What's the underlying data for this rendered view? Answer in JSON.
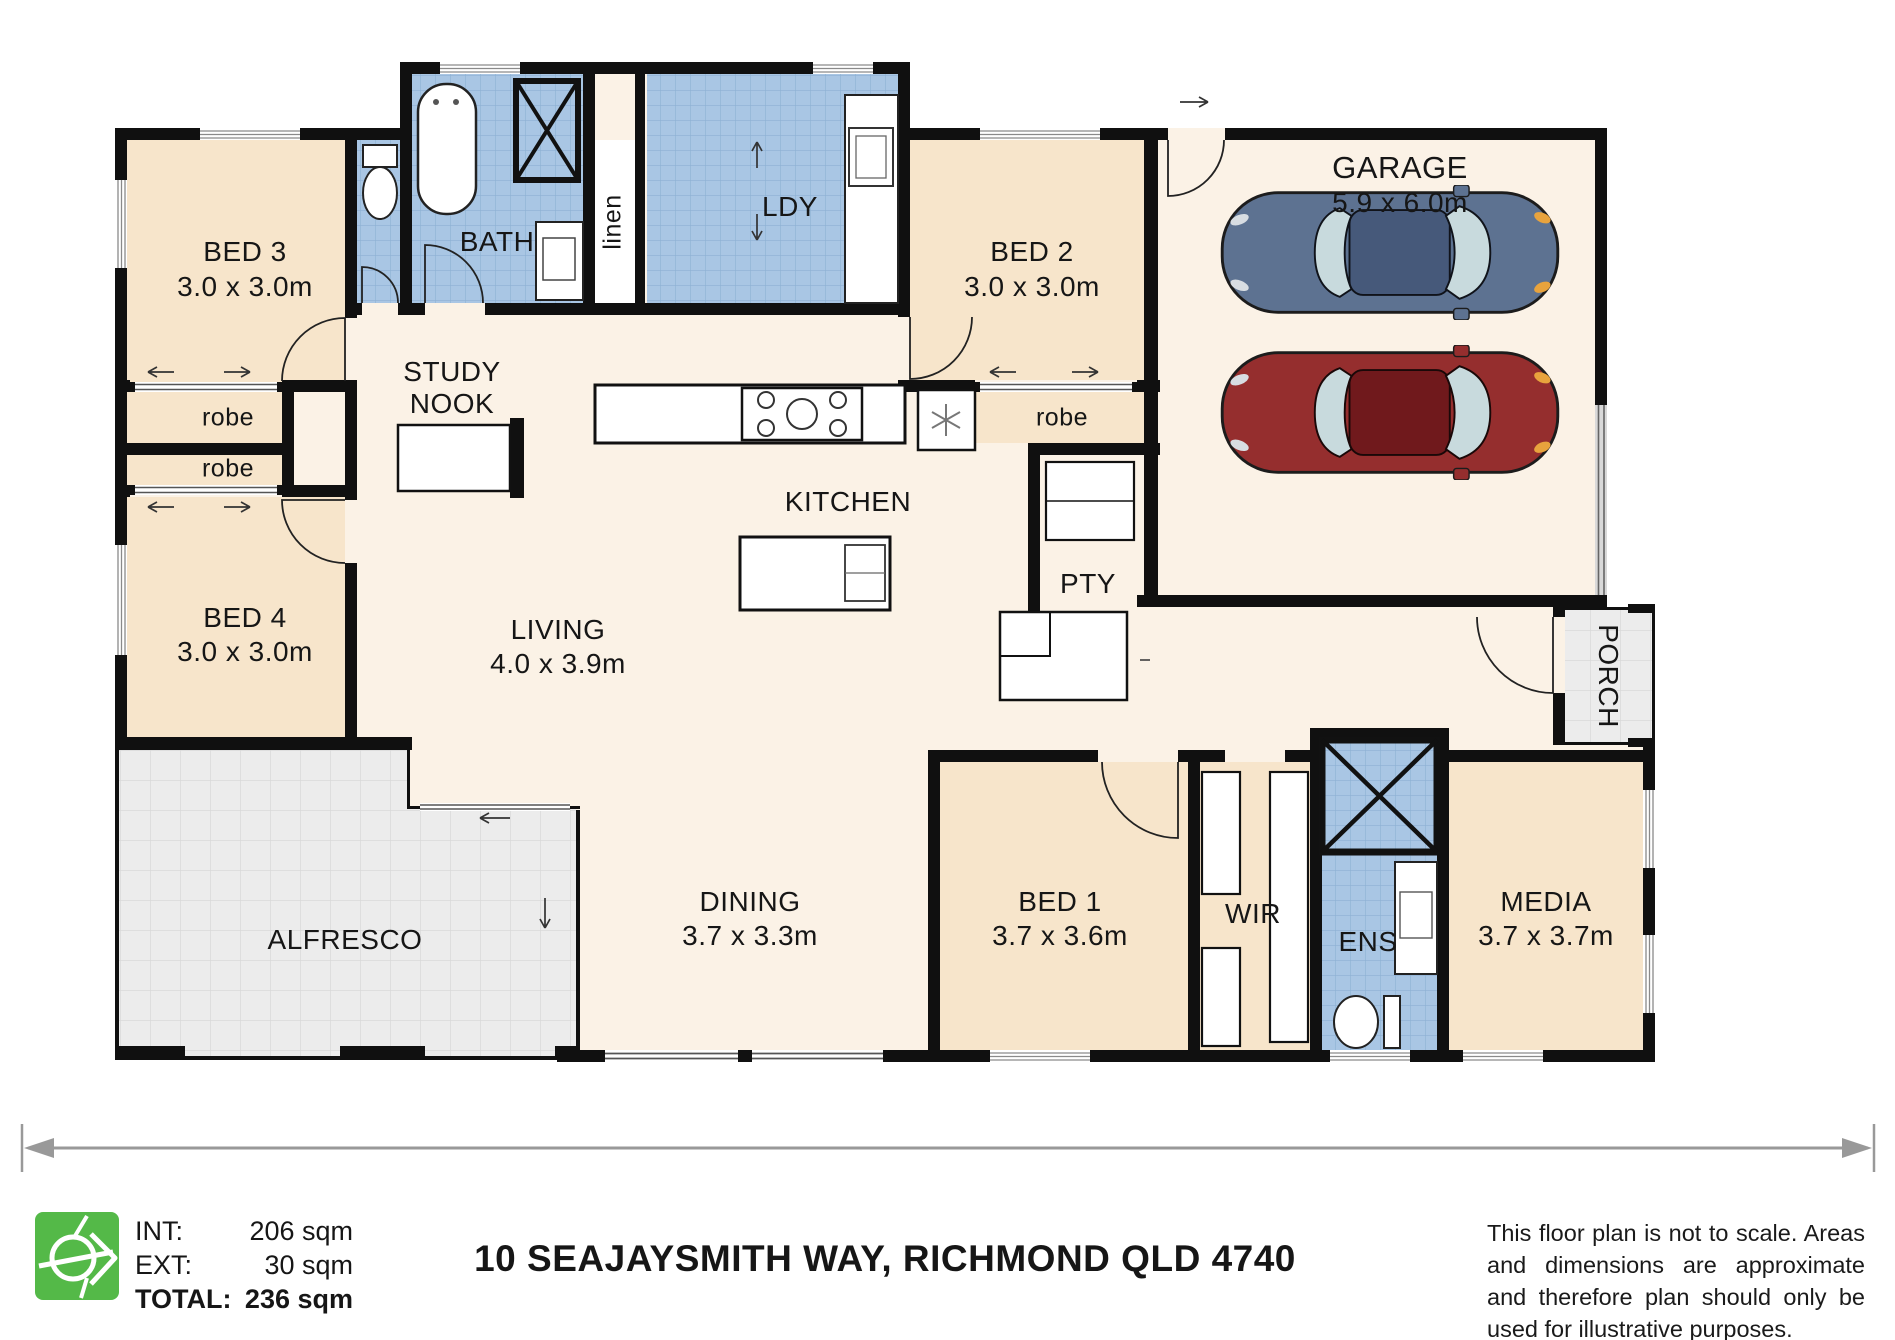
{
  "rooms": {
    "bed3": {
      "name": "BED 3",
      "dims": "3.0 x 3.0m"
    },
    "bed4": {
      "name": "BED 4",
      "dims": "3.0 x 3.0m"
    },
    "bed2": {
      "name": "BED 2",
      "dims": "3.0 x 3.0m"
    },
    "bed1": {
      "name": "BED 1",
      "dims": "3.7 x 3.6m"
    },
    "bath": {
      "name": "BATH"
    },
    "linen": {
      "name": "linen"
    },
    "ldy": {
      "name": "LDY"
    },
    "garage": {
      "name": "GARAGE",
      "dims": "5.9 x 6.0m"
    },
    "robe_bed3_top": {
      "name": "robe"
    },
    "robe_bed3_bot": {
      "name": "robe"
    },
    "robe_bed2": {
      "name": "robe"
    },
    "study_nook": {
      "line1": "STUDY",
      "line2": "NOOK"
    },
    "kitchen": {
      "name": "KITCHEN"
    },
    "pty": {
      "name": "PTY"
    },
    "living": {
      "name": "LIVING",
      "dims": "4.0 x 3.9m"
    },
    "alfresco": {
      "name": "ALFRESCO"
    },
    "dining": {
      "name": "DINING",
      "dims": "3.7 x 3.3m"
    },
    "wir": {
      "name": "WIR"
    },
    "ens": {
      "name": "ENS"
    },
    "media": {
      "name": "MEDIA",
      "dims": "3.7 x 3.7m"
    },
    "porch": {
      "name": "PORCH"
    }
  },
  "footer": {
    "areas": {
      "int_label": "INT:",
      "int_value": "206 sqm",
      "ext_label": "EXT:",
      "ext_value": "30 sqm",
      "total_label": "TOTAL:",
      "total_value": "236 sqm"
    },
    "address": "10 SEAJAYSMITH WAY, RICHMOND QLD 4740",
    "disclaimer": "This floor plan is not to scale. Areas and dimensions are approximate and therefore plan should only be used for illustrative purposes."
  },
  "colors": {
    "wall": "#101010",
    "floor": "#fbf2e6",
    "bedroom": "#f7e5cb",
    "wet": "#a9c6e4",
    "wet-grid": "#8db1d4",
    "outdoor": "#ececec",
    "outdoor-grid": "#d9d9d9",
    "logo-green": "#54b948",
    "arrow-gray": "#999999"
  }
}
